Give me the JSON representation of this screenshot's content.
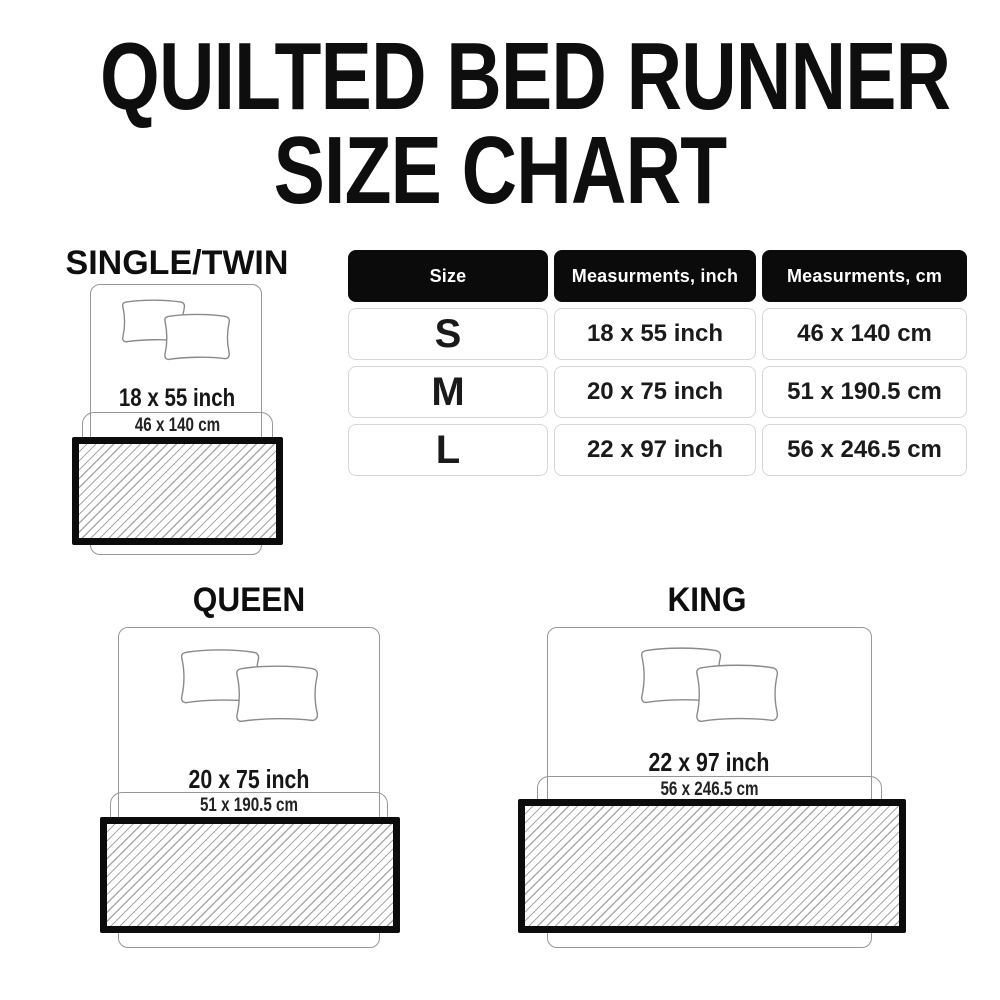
{
  "title": {
    "line1": "QUILTED BED RUNNER",
    "line2": "SIZE CHART"
  },
  "table": {
    "headers": [
      "Size",
      "Measurments, inch",
      "Measurments, cm"
    ],
    "rows": [
      {
        "size": "S",
        "inch": "18 x 55 inch",
        "cm": "46 x 140 cm"
      },
      {
        "size": "M",
        "inch": "20 x 75 inch",
        "cm": "51 x 190.5 cm"
      },
      {
        "size": "L",
        "inch": "22 x 97 inch",
        "cm": "56 x 246.5 cm"
      }
    ]
  },
  "diagrams": [
    {
      "label": "SINGLE/TWIN",
      "inch_label": "18 x 55 inch",
      "cm_label": "46 x 140 cm"
    },
    {
      "label": "QUEEN",
      "inch_label": "20 x 75 inch",
      "cm_label": "51 x 190.5 cm"
    },
    {
      "label": "KING",
      "inch_label": "22 x 97 inch",
      "cm_label": "56 x 246.5 cm"
    }
  ],
  "colors": {
    "background": "#ffffff",
    "text": "#111111",
    "table_header_bg": "#0b0b0b",
    "table_header_text": "#ffffff",
    "table_cell_border": "#d6d6d6",
    "runner_border": "#0c0c0c",
    "hatch_line": "#a9a9a9",
    "outline_gray": "#979797"
  }
}
